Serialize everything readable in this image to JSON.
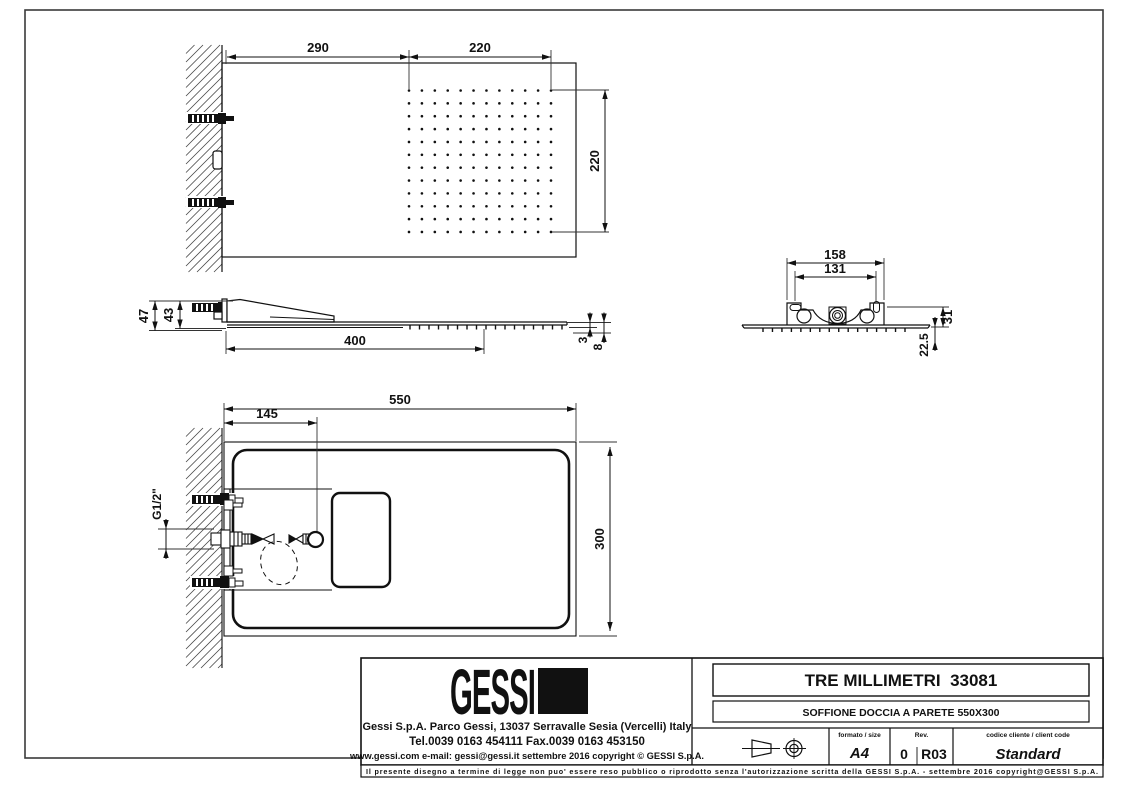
{
  "drawing": {
    "top_view": {
      "dim_wall_to_grid": "290",
      "dim_grid_width": "220",
      "dim_grid_height": "220"
    },
    "side_view": {
      "dim_total_height": "47",
      "dim_body_height": "43",
      "dim_length": "400",
      "dim_plate_thickness": "3",
      "dim_total_thickness": "8"
    },
    "rear_view": {
      "dim_bracket_width": "158",
      "dim_hole_spacing": "131",
      "dim_bracket_height": "31",
      "dim_nozzle_offset": "22.5"
    },
    "plan_view": {
      "dim_total_width": "550",
      "dim_inlet_offset": "145",
      "dim_depth": "300",
      "dim_thread": "G1/2\""
    }
  },
  "title_block": {
    "logo_text": "GESSI",
    "address_line1": "Gessi  S.p.A.  Parco  Gessi,  13037  Serravalle  Sesia  (Vercelli)  Italy",
    "address_line2": "Tel.0039  0163  454111  Fax.0039  0163  453150",
    "address_line3": "www.gessi.com  e-mail:  gessi@gessi.it   settembre  2016  copyright © GESSI  S.p.A.",
    "drawing_title": "TRE MILLIMETRI  33081",
    "drawing_subtitle": "SOFFIONE DOCCIA A PARETE 550X300",
    "format_label": "formato / size",
    "format_value": "A4",
    "rev_label": "Rev.",
    "rev_value_1": "0",
    "rev_value_2": "R03",
    "client_code_label": "codice cliente / client code",
    "client_code_value": "Standard",
    "legal_line": "Il presente disegno a termine di legge non puo' essere reso pubblico o riprodotto senza l'autorizzazione scritta della GESSI S.p.A. - settembre 2016 copyright@GESSI S.p.A."
  }
}
